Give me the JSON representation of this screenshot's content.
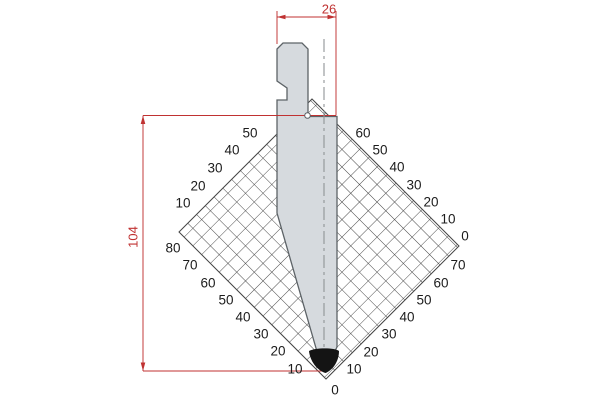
{
  "drawing": {
    "type": "press-brake punch profile with angle grid",
    "dimensions": {
      "width_label": "26",
      "height_label": "104"
    },
    "protractor": {
      "upper_left": [
        "50",
        "40",
        "30",
        "20",
        "10"
      ],
      "upper_right": [
        "60",
        "50",
        "40",
        "30",
        "20",
        "10",
        "0"
      ],
      "lower_left": [
        "80",
        "70",
        "60",
        "50",
        "40",
        "30",
        "20",
        "10"
      ],
      "lower_right": [
        "70",
        "60",
        "50",
        "40",
        "30",
        "20",
        "10"
      ],
      "bottom_zero": "0"
    },
    "colors": {
      "dimension_red": "#c03232",
      "body_fill": "#d6dade",
      "outline": "#5d6367",
      "hatch_line": "#454545",
      "label_text": "#1c1c1c",
      "tip_black": "#141414",
      "background": "#ffffff"
    }
  }
}
